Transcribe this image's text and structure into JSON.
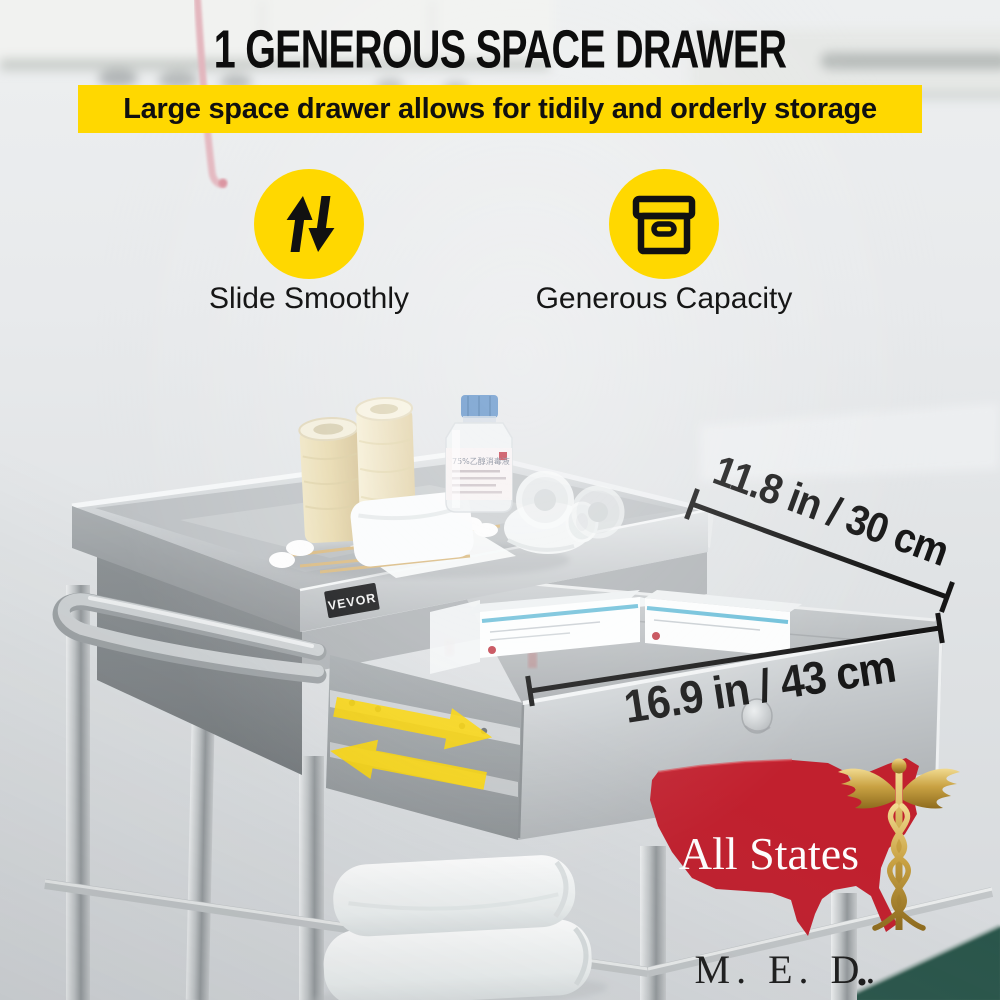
{
  "header": {
    "title": "1 GENEROUS SPACE DRAWER",
    "subtitle": "Large space drawer allows for tidily and orderly storage"
  },
  "features": [
    {
      "icon": "up-down-arrows-icon",
      "label": "Slide Smoothly"
    },
    {
      "icon": "storage-box-icon",
      "label": "Generous Capacity"
    }
  ],
  "annotations": {
    "drawer_depth": "11.8 in / 30 cm",
    "drawer_width": "16.9 in / 43 cm"
  },
  "cart": {
    "brand_badge": "VEVOR",
    "bottle_label": "75%乙醇消毒液"
  },
  "vendor": {
    "name": "All States",
    "abbreviation": "M. E. D."
  },
  "colors": {
    "accent_yellow": "#FFD800",
    "annotation_black": "#161616",
    "vendor_red": "#C1202E",
    "vendor_gold": "#C9A243",
    "table_teal": "#2B564C"
  }
}
